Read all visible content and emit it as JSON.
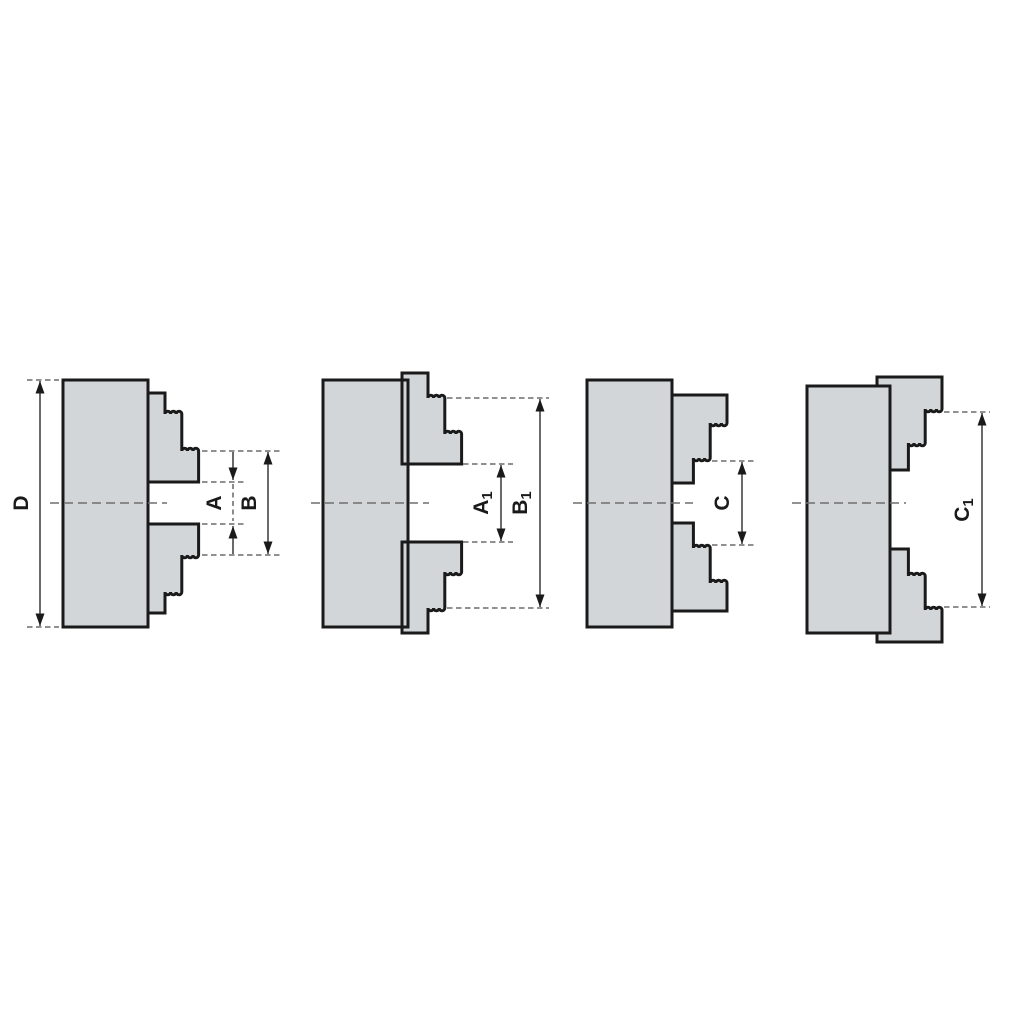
{
  "diagram": {
    "type": "technical-cross-section-diagram",
    "subject": "lathe chuck jaw clamping ranges, four configurations",
    "figure_count": 4,
    "colors": {
      "background": "#ffffff",
      "part_fill": "#d3d6d8",
      "outline": "#1a1a1a",
      "dim": "#1a1a1a",
      "dashed": "#4d4d4d",
      "centerline": "#6f6f6f"
    }
  },
  "figures": [
    {
      "name": "chuck-jaws-stepped-outward-flush",
      "dims": [
        {
          "label": "D",
          "sub": ""
        },
        {
          "label": "A",
          "sub": ""
        },
        {
          "label": "B",
          "sub": ""
        }
      ]
    },
    {
      "name": "chuck-jaws-stepped-outward-extended",
      "dims": [
        {
          "label": "A",
          "sub": "1"
        },
        {
          "label": "B",
          "sub": "1"
        }
      ]
    },
    {
      "name": "chuck-jaws-stepped-inward-flush",
      "dims": [
        {
          "label": "C",
          "sub": ""
        }
      ]
    },
    {
      "name": "chuck-jaws-stepped-inward-extended",
      "dims": [
        {
          "label": "C",
          "sub": "1"
        }
      ]
    }
  ]
}
